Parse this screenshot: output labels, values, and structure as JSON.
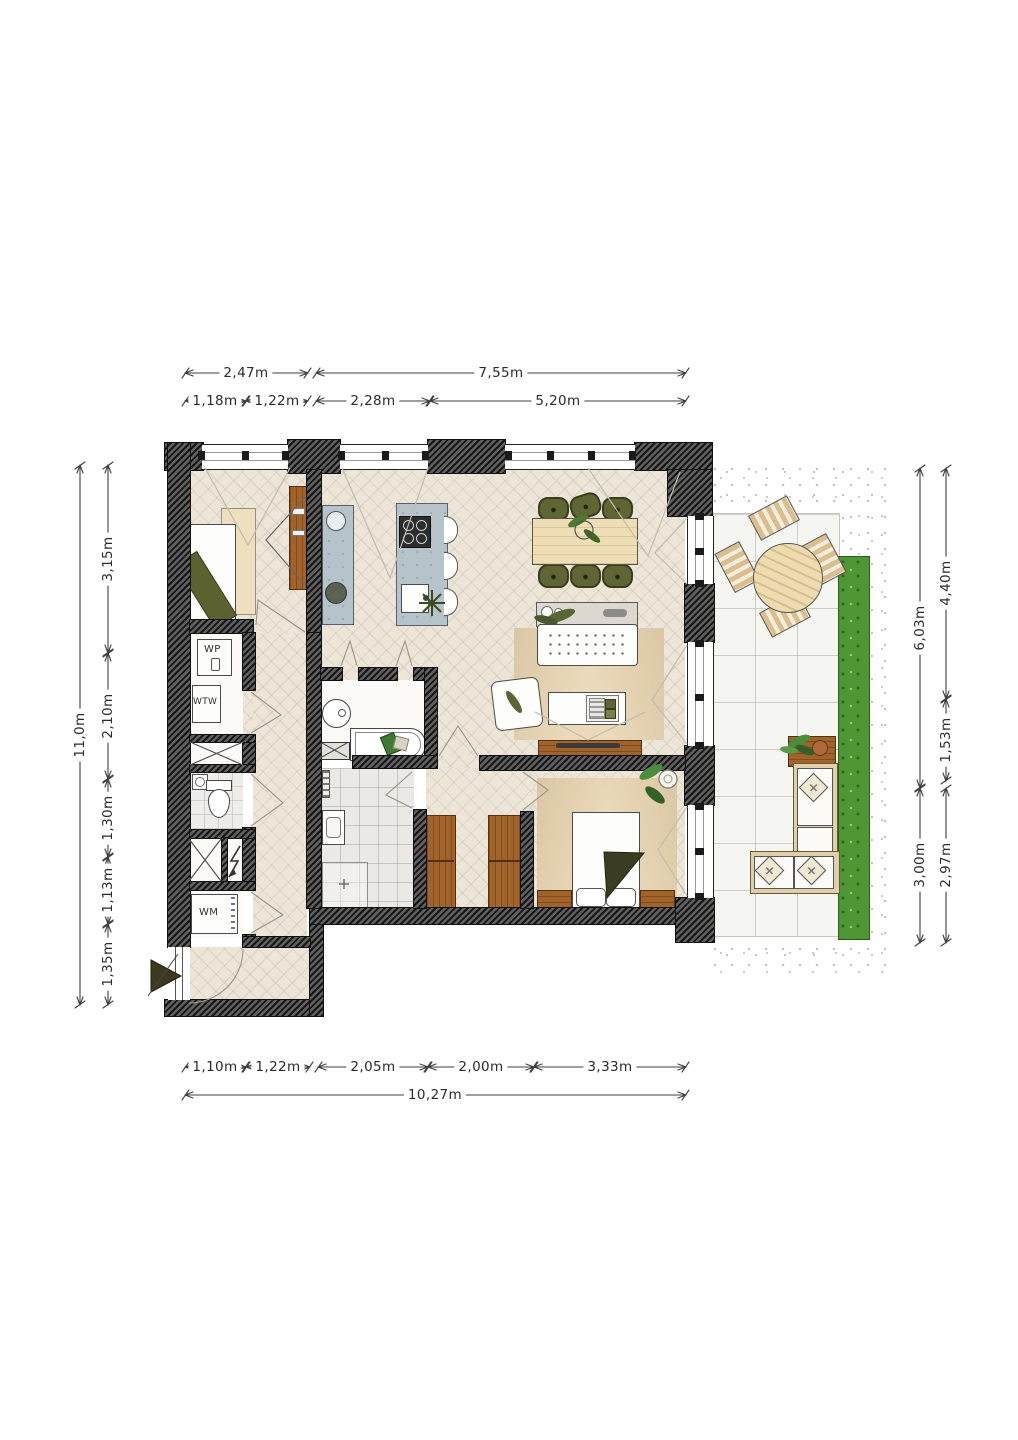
{
  "plan_type": "apartment floor plan",
  "colors": {
    "wall": "#3a3a3a",
    "floor_wood": "#ece5d8",
    "tile": "#eae9e5",
    "wood_furniture": "#a2632a",
    "light_wood": "#eedcb0",
    "chair_olive": "#5f6633",
    "hedge_green": "#4f9634",
    "kitchen_counter": "#b7c3ca",
    "blanket_olive": "#3a3d22"
  },
  "labels": {
    "heat_pump": "WP",
    "heat_recovery": "WTW",
    "washing_machine": "WM"
  },
  "dims": {
    "t1a": "2,47m",
    "t1b": "7,55m",
    "t2a": "1,18m",
    "t2b": "1,22m",
    "t2c": "2,28m",
    "t2d": "5,20m",
    "b1a": "1,10m",
    "b1b": "1,22m",
    "b1c": "2,05m",
    "b1d": "2,00m",
    "b1e": "3,33m",
    "b2a": "10,27m",
    "lo": "11,0m",
    "l1": "3,15m",
    "l2": "2,10m",
    "l3": "1,30m",
    "l4": "1,13m",
    "l5": "1,35m",
    "ro1": "6,03m",
    "ro2": "3,00m",
    "r1": "4,40m",
    "r2": "1,53m",
    "r3": "2,97m"
  }
}
